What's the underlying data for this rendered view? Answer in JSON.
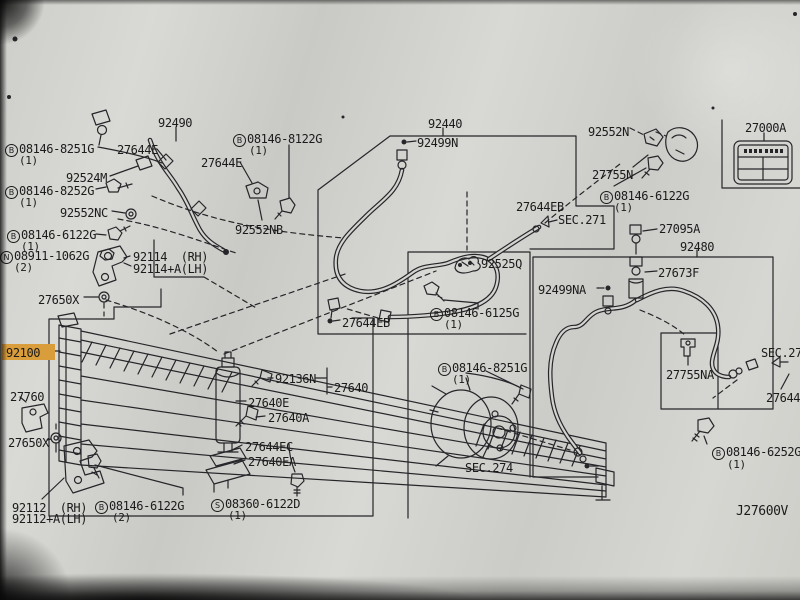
{
  "diagram": {
    "drawing_number": "J27600V",
    "highlighted_part": "92100",
    "highlight_color": "#d99d3b",
    "sections": [
      "SEC.271",
      "SEC.274",
      "SEC.27"
    ],
    "labels": {
      "p92490": {
        "text": "92490"
      },
      "b8251g_a": {
        "prefix": "B",
        "text": "08146-8251G",
        "qty": "(1)"
      },
      "p27644e_a": {
        "text": "27644E"
      },
      "p92524m": {
        "text": "92524M"
      },
      "b8252g": {
        "prefix": "B",
        "text": "08146-8252G",
        "qty": "(1)"
      },
      "p92552nc": {
        "text": "92552NC"
      },
      "b6122g_a": {
        "prefix": "B",
        "text": "08146-6122G",
        "qty": "(1)"
      },
      "n1062g": {
        "prefix": "N",
        "text": "08911-1062G",
        "qty": "(2)"
      },
      "p92114": {
        "text": "92114  (RH)"
      },
      "p92114a": {
        "text": "92114+A(LH)"
      },
      "p27650x_a": {
        "text": "27650X"
      },
      "p92100": {
        "text": "92100"
      },
      "p27760": {
        "text": "27760"
      },
      "p27650x_b": {
        "text": "27650X"
      },
      "p92112": {
        "text": "92112  (RH)"
      },
      "p92112a": {
        "text": "92112+A(LH)"
      },
      "b6122g_b": {
        "prefix": "B",
        "text": "08146-6122G",
        "qty": "(2)"
      },
      "s6122d": {
        "prefix": "S",
        "text": "08360-6122D",
        "qty": "(1)"
      },
      "p92136n": {
        "text": "92136N"
      },
      "p27640": {
        "text": "27640"
      },
      "p27640e": {
        "text": "27640E"
      },
      "p27640a": {
        "text": "27640A"
      },
      "p27644ec": {
        "text": "27644EC"
      },
      "p27640ea": {
        "text": "27640EA"
      },
      "b8122g": {
        "prefix": "B",
        "text": "08146-8122G",
        "qty": "(1)"
      },
      "p27644e_b": {
        "text": "27644E"
      },
      "p92552nb": {
        "text": "92552NB"
      },
      "p92440": {
        "text": "92440"
      },
      "p92499n": {
        "text": "92499N"
      },
      "p27644eb_a": {
        "text": "27644EB"
      },
      "sec271_a": {
        "text": "SEC.271"
      },
      "p27644eb_b": {
        "text": "27644EB"
      },
      "p92525q": {
        "text": "92525Q"
      },
      "b6125g": {
        "prefix": "B",
        "text": "08146-6125G",
        "qty": "(1)"
      },
      "p92499na": {
        "text": "92499NA"
      },
      "p92552n": {
        "text": "92552N"
      },
      "p27755n": {
        "text": "27755N"
      },
      "b6122g_c": {
        "prefix": "B",
        "text": "08146-6122G",
        "qty": "(1)"
      },
      "p27000a": {
        "text": "27000A"
      },
      "p27095a": {
        "text": "27095A"
      },
      "p92480": {
        "text": "92480"
      },
      "p27673f": {
        "text": "27673F"
      },
      "p27755na": {
        "text": "27755NA"
      },
      "sec27_cut": {
        "text": "SEC.27"
      },
      "p27644_cut": {
        "text": "27644"
      },
      "b6252g": {
        "prefix": "B",
        "text": "08146-6252G",
        "qty": "(1)"
      },
      "b8251g_b": {
        "prefix": "B",
        "text": "08146-8251G",
        "qty": "(1)"
      },
      "sec274": {
        "text": "SEC.274"
      },
      "j27600v": {
        "text": "J27600V"
      }
    }
  }
}
